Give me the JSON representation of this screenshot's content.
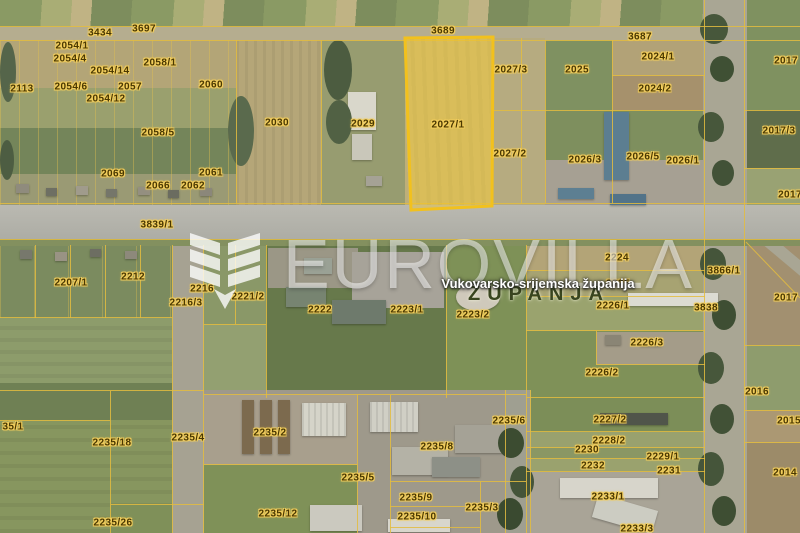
{
  "watermark": {
    "brand": "EUROVILLA",
    "logo": "eurovilla-chevron-logo"
  },
  "geo_labels": {
    "county": "Vukovarsko-srijemska županija",
    "city": "ŽUPANJA"
  },
  "highlighted_parcel": {
    "id": "2027/1"
  },
  "colors": {
    "parcel-line": "#e3bc3f",
    "parcel-text": "#4a3800",
    "parcel-halo": "rgba(242,205,92,0.95)",
    "highlight-fill": "rgba(244,201,37,0.40)",
    "highlight-stroke": "#f2c11d",
    "watermark-color": "rgba(255,255,255,0.52)",
    "county-color": "#ffffff",
    "city-color": "#39451f"
  },
  "parcels": [
    {
      "id": "3434",
      "x": 100,
      "y": 33
    },
    {
      "id": "3697",
      "x": 144,
      "y": 29
    },
    {
      "id": "2054/1",
      "x": 72,
      "y": 46
    },
    {
      "id": "2054/4",
      "x": 70,
      "y": 59
    },
    {
      "id": "2054/14",
      "x": 110,
      "y": 71
    },
    {
      "id": "2058/1",
      "x": 160,
      "y": 63
    },
    {
      "id": "2113",
      "x": 22,
      "y": 89
    },
    {
      "id": "2054/6",
      "x": 71,
      "y": 87
    },
    {
      "id": "2057",
      "x": 130,
      "y": 87
    },
    {
      "id": "2060",
      "x": 211,
      "y": 85
    },
    {
      "id": "2054/12",
      "x": 106,
      "y": 99
    },
    {
      "id": "2058/5",
      "x": 158,
      "y": 133
    },
    {
      "id": "2069",
      "x": 113,
      "y": 174
    },
    {
      "id": "2061",
      "x": 211,
      "y": 173
    },
    {
      "id": "2066",
      "x": 158,
      "y": 186
    },
    {
      "id": "2062",
      "x": 193,
      "y": 186
    },
    {
      "id": "3839/1",
      "x": 157,
      "y": 225
    },
    {
      "id": "3689",
      "x": 443,
      "y": 31
    },
    {
      "id": "2030",
      "x": 277,
      "y": 123
    },
    {
      "id": "2029",
      "x": 363,
      "y": 124
    },
    {
      "id": "2027/1",
      "x": 448,
      "y": 125
    },
    {
      "id": "2027/3",
      "x": 511,
      "y": 70
    },
    {
      "id": "2027/2",
      "x": 510,
      "y": 154
    },
    {
      "id": "2025",
      "x": 577,
      "y": 70
    },
    {
      "id": "3687",
      "x": 640,
      "y": 37
    },
    {
      "id": "2024/1",
      "x": 658,
      "y": 57
    },
    {
      "id": "2024/2",
      "x": 655,
      "y": 89
    },
    {
      "id": "2017",
      "x": 786,
      "y": 61
    },
    {
      "id": "2017/3",
      "x": 779,
      "y": 131
    },
    {
      "id": "2017",
      "x": 790,
      "y": 195
    },
    {
      "id": "2026/3",
      "x": 585,
      "y": 160
    },
    {
      "id": "2026/5",
      "x": 643,
      "y": 157
    },
    {
      "id": "2026/1",
      "x": 683,
      "y": 161
    },
    {
      "id": "2207/1",
      "x": 71,
      "y": 283
    },
    {
      "id": "2212",
      "x": 133,
      "y": 277
    },
    {
      "id": "2216",
      "x": 202,
      "y": 289
    },
    {
      "id": "2216/3",
      "x": 186,
      "y": 303
    },
    {
      "id": "2221/2",
      "x": 248,
      "y": 297
    },
    {
      "id": "2222",
      "x": 320,
      "y": 310
    },
    {
      "id": "2223/1",
      "x": 407,
      "y": 310
    },
    {
      "id": "2223/2",
      "x": 473,
      "y": 315
    },
    {
      "id": "2224",
      "x": 617,
      "y": 258
    },
    {
      "id": "2225",
      "x": 618,
      "y": 284
    },
    {
      "id": "2226/1",
      "x": 613,
      "y": 306
    },
    {
      "id": "3838",
      "x": 706,
      "y": 308
    },
    {
      "id": "3866/1",
      "x": 724,
      "y": 271
    },
    {
      "id": "2017",
      "x": 786,
      "y": 298
    },
    {
      "id": "2226/3",
      "x": 647,
      "y": 343
    },
    {
      "id": "2226/2",
      "x": 602,
      "y": 373
    },
    {
      "id": "2016",
      "x": 757,
      "y": 392
    },
    {
      "id": "2015",
      "x": 789,
      "y": 421
    },
    {
      "id": "2014",
      "x": 785,
      "y": 473
    },
    {
      "id": "35/1",
      "x": 13,
      "y": 427
    },
    {
      "id": "2235/18",
      "x": 112,
      "y": 443
    },
    {
      "id": "2235/4",
      "x": 188,
      "y": 438
    },
    {
      "id": "2235/2",
      "x": 270,
      "y": 433
    },
    {
      "id": "2235/6",
      "x": 509,
      "y": 421
    },
    {
      "id": "2235/8",
      "x": 437,
      "y": 447
    },
    {
      "id": "2235/5",
      "x": 358,
      "y": 478
    },
    {
      "id": "2235/12",
      "x": 278,
      "y": 514
    },
    {
      "id": "2235/9",
      "x": 416,
      "y": 498
    },
    {
      "id": "2235/10",
      "x": 417,
      "y": 517
    },
    {
      "id": "2235/3",
      "x": 482,
      "y": 508
    },
    {
      "id": "2235/26",
      "x": 113,
      "y": 523
    },
    {
      "id": "2227/2",
      "x": 610,
      "y": 420
    },
    {
      "id": "2228/2",
      "x": 609,
      "y": 441
    },
    {
      "id": "2230",
      "x": 587,
      "y": 450
    },
    {
      "id": "2232",
      "x": 593,
      "y": 466
    },
    {
      "id": "2229/1",
      "x": 663,
      "y": 457
    },
    {
      "id": "2231",
      "x": 669,
      "y": 471
    },
    {
      "id": "2233/1",
      "x": 608,
      "y": 497
    },
    {
      "id": "2233/3",
      "x": 637,
      "y": 529
    }
  ]
}
